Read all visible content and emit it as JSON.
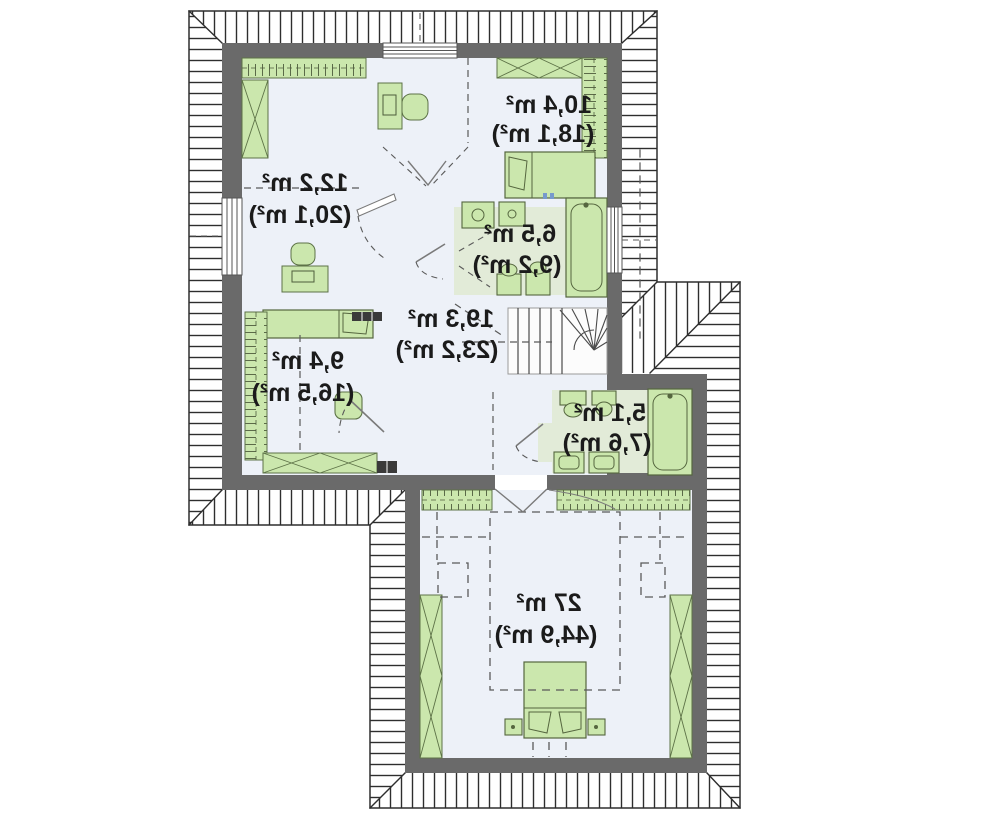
{
  "plan": {
    "rooms": {
      "dressing": {
        "area": "12,2 m²",
        "total": "(20,1 m²)"
      },
      "bedroom_top": {
        "area": "10,4 m²",
        "total": "(18,1 m²)"
      },
      "bathroom": {
        "area": "6,5 m²",
        "total": "(9,2 m²)"
      },
      "hall": {
        "area": "19,3 m²",
        "total": "(23,2 m²)"
      },
      "bedroom_left": {
        "area": "9,4 m²",
        "total": "(16,5 m²)"
      },
      "toilet": {
        "area": "5,1 m²",
        "total": "(7,6 m²)"
      },
      "master_bedroom": {
        "area": "27 m²",
        "total": "(44,9 m²)"
      }
    },
    "colors": {
      "wall": "#6a6a6a",
      "room_floor": "#edf1f8",
      "bathroom_floor": "#e2ebd8",
      "furniture_fill": "#cbe7ad",
      "furniture_stroke": "#5d7247",
      "hatch_line": "#2e2e2e",
      "dash_line": "#5a5a5a",
      "stair_fill": "#fcfcfc",
      "text": "#1b1b1b"
    }
  }
}
